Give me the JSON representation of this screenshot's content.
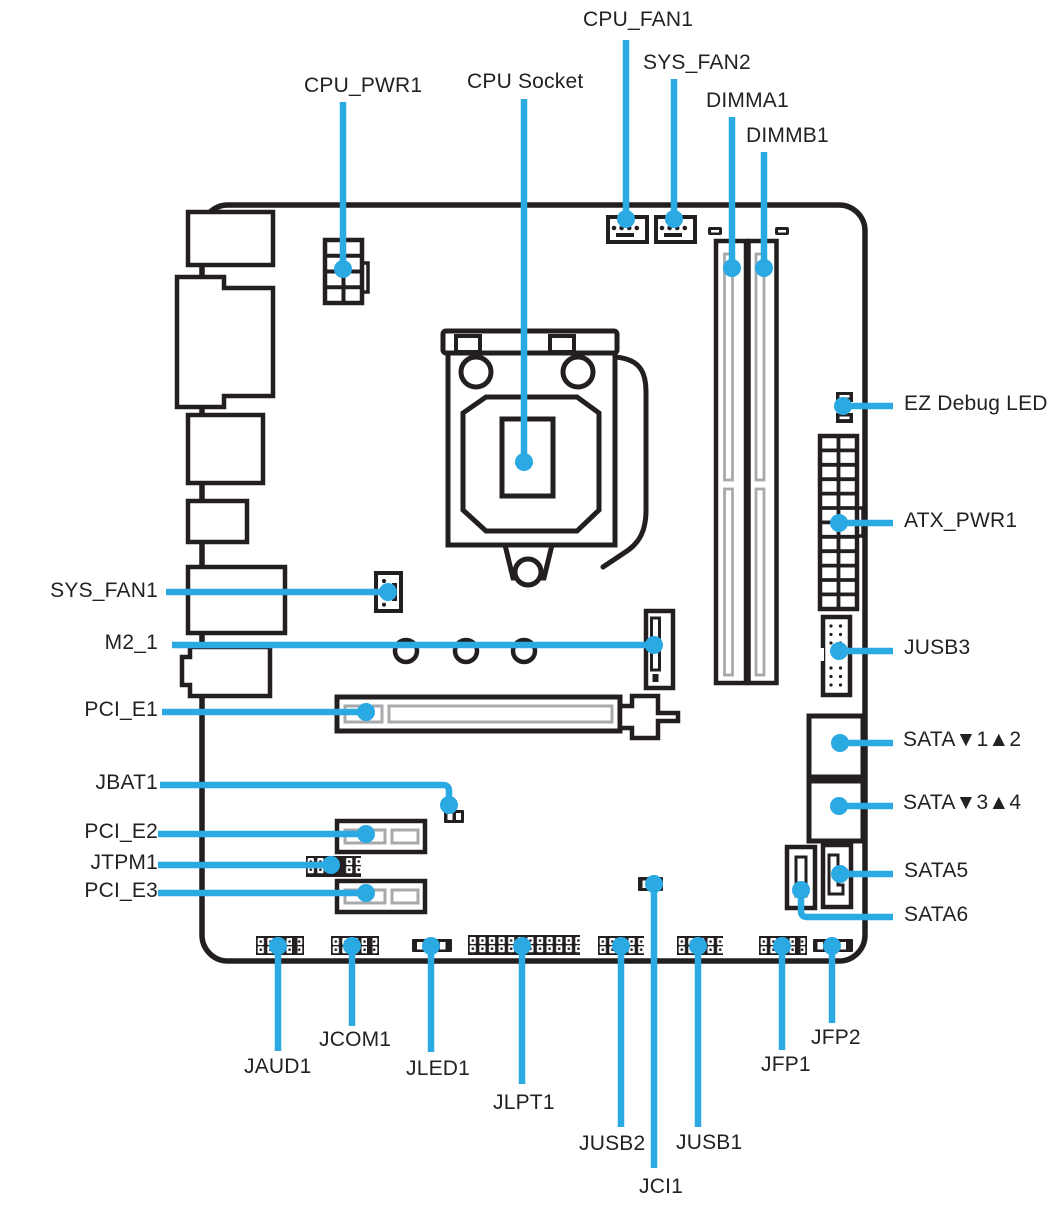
{
  "figure": {
    "colors": {
      "callout": "#2aa9e2",
      "ink": "#231f20",
      "slot": "#a7a9ac"
    },
    "labels": {
      "cpu_fan1": "CPU_FAN1",
      "sys_fan2": "SYS_FAN2",
      "cpu_pwr1": "CPU_PWR1",
      "cpu_socket": "CPU Socket",
      "dimma1": "DIMMA1",
      "dimmb1": "DIMMB1",
      "ez_debug_led": "EZ Debug LED",
      "atx_pwr1": "ATX_PWR1",
      "sys_fan1": "SYS_FAN1",
      "m2_1": "M2_1",
      "jusb3": "JUSB3",
      "pci_e1": "PCI_E1",
      "sata_1_2": "SATA▼1▲2",
      "jbat1": "JBAT1",
      "sata_3_4": "SATA▼3▲4",
      "pci_e2": "PCI_E2",
      "jtpm1": "JTPM1",
      "sata5": "SATA5",
      "pci_e3": "PCI_E3",
      "sata6": "SATA6",
      "jaud1": "JAUD1",
      "jcom1": "JCOM1",
      "jled1": "JLED1",
      "jlpt1": "JLPT1",
      "jusb2": "JUSB2",
      "jusb1": "JUSB1",
      "jci1": "JCI1",
      "jfp1": "JFP1",
      "jfp2": "JFP2"
    }
  }
}
